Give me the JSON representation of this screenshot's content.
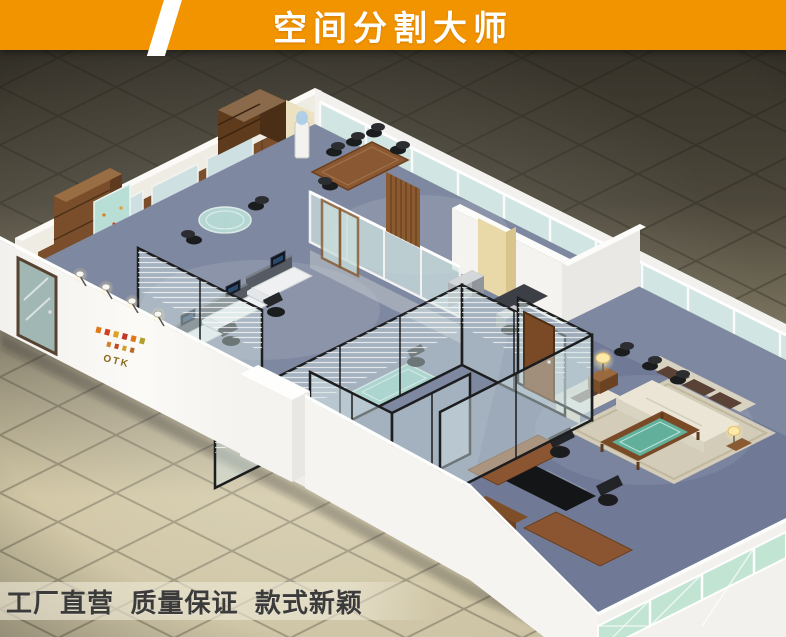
{
  "banner": {
    "title": "空间分割大师",
    "background_color": "#F29400",
    "text_color": "#FFFFFF"
  },
  "tagline": {
    "text": "工厂直营  质量保证  款式新颖",
    "text_color": "#3B3B3B"
  },
  "scene": {
    "type": "3d-isometric-office-interior-render",
    "wall_logo_text": "OTK",
    "palette": {
      "floor_tile_light": "#D8CDAA",
      "floor_tile_dark": "#3A362C",
      "carpet_blue": "#7E88A0",
      "carpet_exec": "#6D7894",
      "wall_white": "#F5F4F1",
      "wood_brown": "#8A5530",
      "wood_dark": "#5F3B1E",
      "glass_blue": "#CFE4E2",
      "glass_green": "#BFE4D2",
      "partition_frame_black": "#1C1D1F",
      "marble_sill_black": "#141416",
      "sofa_cream": "#E9E4D4",
      "cushion_brown": "#5A4236",
      "desk_leather_black": "#141517",
      "table_glass_teal": "#8ECFC2",
      "lamp_glow": "#FFE9A8"
    }
  }
}
